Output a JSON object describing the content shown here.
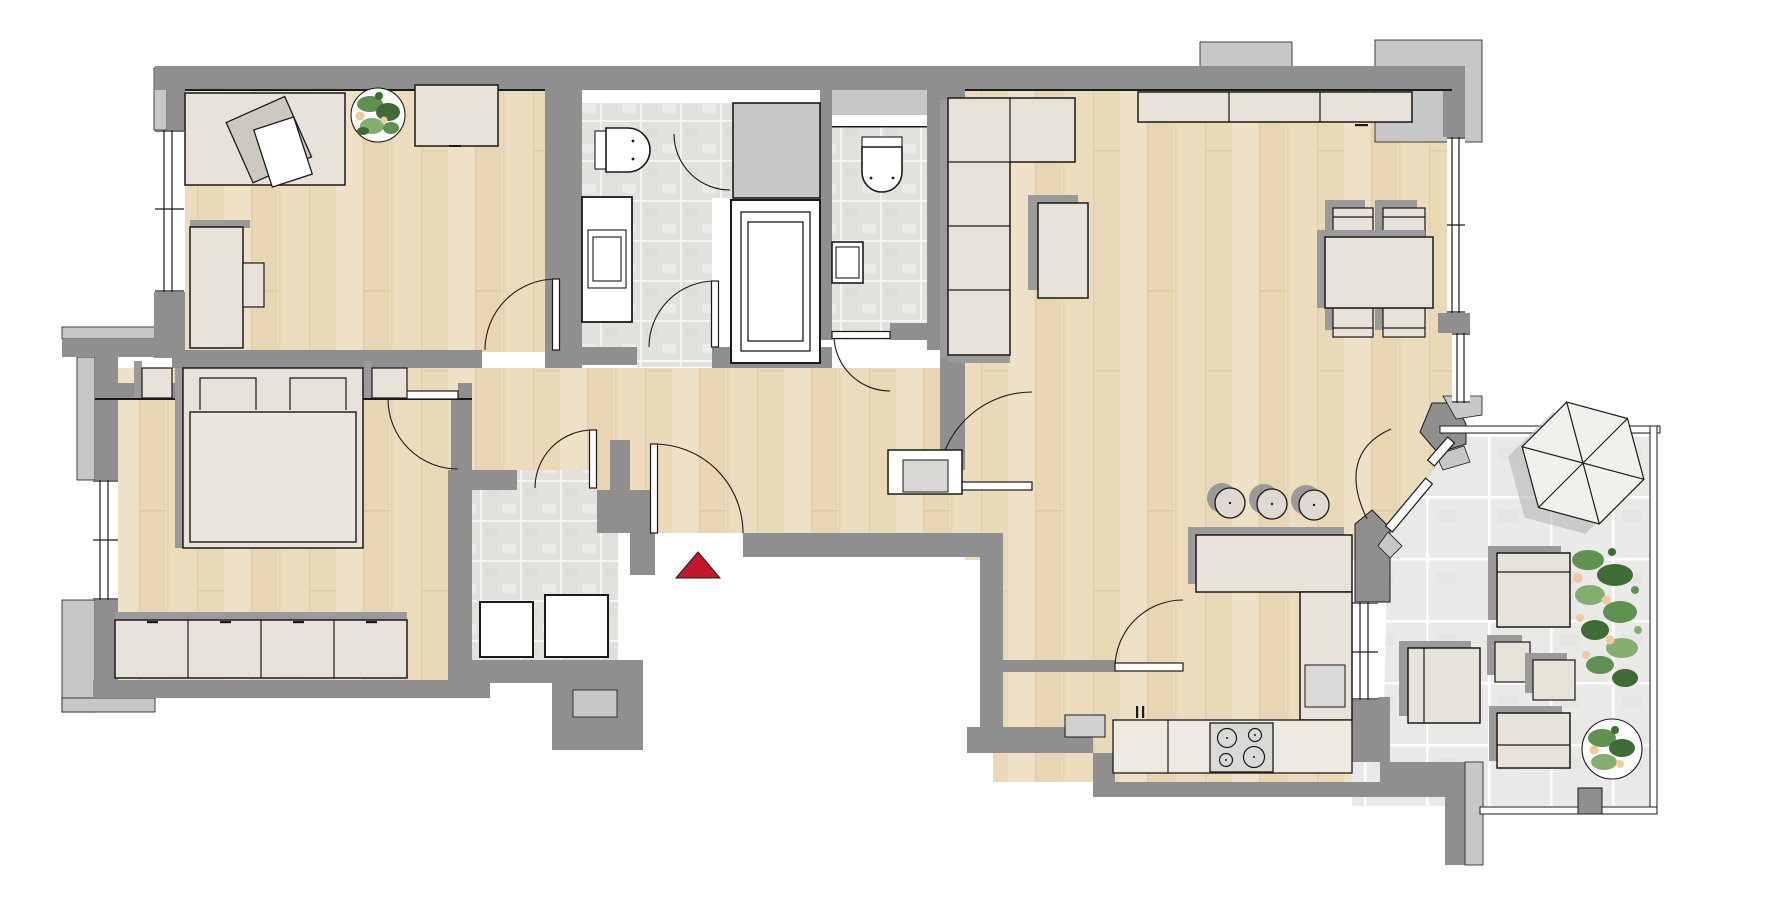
{
  "title": "apartment-floor-plan",
  "plan": {
    "type": "residential floor plan, top view",
    "units_text_visible": false,
    "entrance": {
      "marker": "red-triangle-arrow",
      "direction": "up",
      "location": "bottom center at entrance door"
    },
    "rooms": [
      {
        "id": "office",
        "floor": "wood",
        "furniture": [
          "desk",
          "office-chair",
          "paper-sheet",
          "potted-plant",
          "sideboard",
          "tall-cabinet"
        ]
      },
      {
        "id": "bathroom",
        "floor": "tile",
        "furniture": [
          "toilet",
          "vanity-washbasin",
          "installation-niche",
          "bathtub"
        ]
      },
      {
        "id": "wc",
        "floor": "tile",
        "furniture": [
          "toilet",
          "small-washbasin",
          "duct-shaft"
        ]
      },
      {
        "id": "living-dining",
        "floor": "wood",
        "furniture": [
          "corner-sofa",
          "coffee-table",
          "sideboard-row",
          "dining-table",
          "four-chairs"
        ]
      },
      {
        "id": "bedroom",
        "floor": "wood",
        "furniture": [
          "double-bed",
          "two-pillows",
          "nightstand-left",
          "nightstand-right",
          "wardrobe-4-doors"
        ]
      },
      {
        "id": "hallway",
        "floor": "wood",
        "furniture": [
          "entrance-door",
          "white-cabinet"
        ]
      },
      {
        "id": "utility-room",
        "floor": "tile",
        "furniture": [
          "washing-machine",
          "dryer"
        ]
      },
      {
        "id": "kitchen",
        "floor": "wood",
        "furniture": [
          "bar-counter",
          "three-bar-stools",
          "l-counter",
          "sink",
          "cooktop-4-burners",
          "base-cabinets"
        ]
      },
      {
        "id": "terrace",
        "floor": "large-tile",
        "furniture": [
          "parasol-hexagonal",
          "lounge-seat-1",
          "lounge-seat-2",
          "lounge-seat-3",
          "cube-table-1",
          "cube-table-2",
          "planter-bush",
          "potted-plant",
          "railing"
        ]
      }
    ],
    "door_count": 10,
    "window_count": 5
  },
  "colors": {
    "wall": "#8f8f8f",
    "wall_light": "#c7c7c7",
    "wood": "#ecdcbd",
    "wood_streak": "#e3d0a9",
    "wood_streak_light": "#f2e5cc",
    "tile": "#e3e1de",
    "tile_line": "#f5f4f2",
    "terrace_tile": "#e9e9e8",
    "terrace_line": "#ffffff",
    "furniture": "#e7e3d8",
    "fixture": "#ffffff",
    "appliance": "#d9d9d7",
    "shadow": "#9a9a9a",
    "outline": "#1a1a1a",
    "entrance_arrow": "#c5162e",
    "plant_dark": "#3f6b34",
    "plant_mid": "#5f9150",
    "plant_light": "#83ae6d",
    "plant_accent": "#f3c89d"
  }
}
